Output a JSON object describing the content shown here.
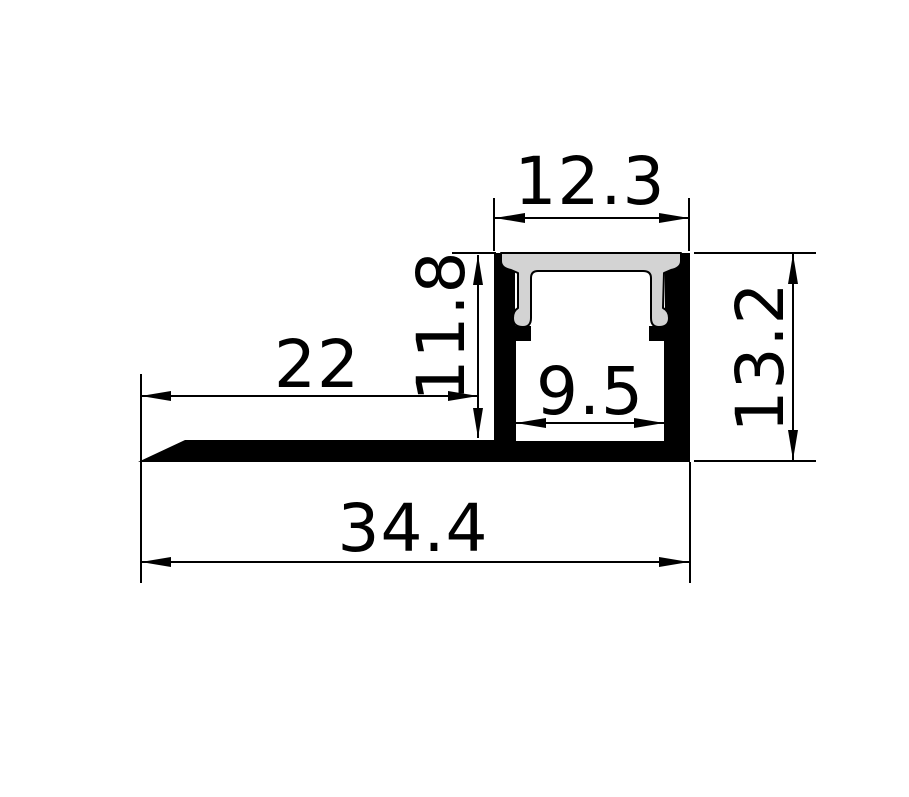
{
  "drawing": {
    "dimensions": {
      "top_width": "12.3",
      "recess_depth": "11.8",
      "flange_length": "22",
      "inner_width": "9.5",
      "overall_height": "13.2",
      "overall_width": "34.4"
    },
    "colors": {
      "background": "#ffffff",
      "line": "#000000",
      "profile_fill": "#000000",
      "diffuser_fill": "#d3d3d3"
    }
  }
}
